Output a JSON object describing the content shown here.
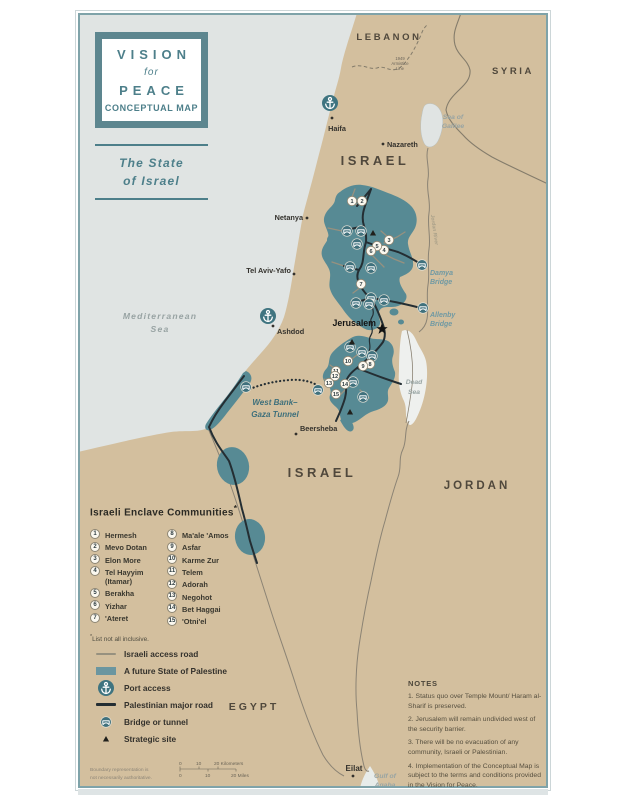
{
  "colors": {
    "teal": "#4d7f8a",
    "palestine_fill": "#578a94",
    "land": "#d3bf9e",
    "sea": "#e0e4e3",
    "road_black": "#242e33",
    "road_gray": "#97917f",
    "border_gray": "#847c6b"
  },
  "title_box": {
    "line1": "VISION",
    "line2": "for",
    "line3": "PEACE",
    "line4": "CONCEPTUAL MAP"
  },
  "subtitle": {
    "line1": "The State",
    "line2": "of Israel"
  },
  "map": {
    "country_labels": [
      {
        "label": "LEBANON",
        "x": 389,
        "y": 40,
        "size": 9.5,
        "ls": 2.6
      },
      {
        "label": "SYRIA",
        "x": 513,
        "y": 74,
        "size": 9.5,
        "ls": 2.6
      },
      {
        "label": "ISRAEL",
        "x": 375,
        "y": 165,
        "size": 13,
        "ls": 3.5
      },
      {
        "label": "ISRAEL",
        "x": 322,
        "y": 477,
        "size": 13,
        "ls": 3.5
      },
      {
        "label": "JORDAN",
        "x": 477,
        "y": 489,
        "size": 11.5,
        "ls": 3
      },
      {
        "label": "EGYPT",
        "x": 254,
        "y": 710,
        "size": 10.5,
        "ls": 3
      }
    ],
    "cities": [
      {
        "name": "Haifa",
        "lx": 337,
        "ly": 131,
        "anchor": "middle",
        "dx": 332,
        "dy": 118
      },
      {
        "name": "Nazareth",
        "lx": 387,
        "ly": 147,
        "anchor": "start",
        "dx": 383,
        "dy": 144
      },
      {
        "name": "Netanya",
        "lx": 303,
        "ly": 220,
        "anchor": "end",
        "dx": 307,
        "dy": 218
      },
      {
        "name": "Tel Aviv-Yafo",
        "lx": 291,
        "ly": 273,
        "anchor": "end",
        "dx": 294,
        "dy": 274
      },
      {
        "name": "Ashdod",
        "lx": 277,
        "ly": 334,
        "anchor": "start",
        "dx": 273,
        "dy": 326
      },
      {
        "name": "Beersheba",
        "lx": 300,
        "ly": 431,
        "anchor": "start",
        "dx": 296,
        "dy": 434
      },
      {
        "name": "Eilat",
        "lx": 354,
        "ly": 771,
        "anchor": "middle",
        "dx": 353,
        "dy": 776,
        "bold": true
      }
    ],
    "jerusalem": {
      "label": "Jerusalem",
      "lx": 376,
      "ly": 326,
      "star_x": 382,
      "star_y": 329
    },
    "waters": [
      {
        "lines": [
          "Mediterranean",
          "Sea"
        ],
        "x": 160,
        "y": 319,
        "lh": 13,
        "large": true,
        "name": "mediterranean-sea-label"
      },
      {
        "lines": [
          "Sea of",
          "Galilee"
        ],
        "x": 453,
        "y": 119,
        "lh": 9,
        "name": "sea-of-galilee-label"
      },
      {
        "lines": [
          "Dead",
          "Sea"
        ],
        "x": 414,
        "y": 384,
        "lh": 10,
        "name": "dead-sea-label"
      },
      {
        "lines": [
          "Gulf of",
          "Aqaba"
        ],
        "x": 385,
        "y": 778,
        "lh": 9,
        "name": "gulf-of-aqaba-label"
      }
    ],
    "river_label": {
      "text": "Jordan River",
      "x": 433,
      "y": 230,
      "rotate": 82
    },
    "bridge_names": [
      {
        "lines": [
          "Damya",
          "Bridge"
        ],
        "x": 430,
        "y": 275,
        "lh": 9,
        "anchor": "start",
        "name": "damya-bridge-label"
      },
      {
        "lines": [
          "Allenby",
          "Bridge"
        ],
        "x": 430,
        "y": 317,
        "lh": 9,
        "anchor": "start",
        "name": "allenby-bridge-label"
      }
    ],
    "tunnel_label": {
      "lines": [
        "West Bank–",
        "Gaza Tunnel"
      ],
      "x": 275,
      "y": 405,
      "lh": 12,
      "name": "west-bank-gaza-tunnel-label"
    },
    "armistice_label": {
      "lines": [
        "1949",
        "Armistice",
        "Line"
      ],
      "x": 400,
      "y": 60,
      "lh": 5,
      "name": "armistice-line-label"
    },
    "enclave_markers": [
      {
        "n": "1",
        "x": 352,
        "y": 201
      },
      {
        "n": "2",
        "x": 362,
        "y": 201
      },
      {
        "n": "3",
        "x": 389,
        "y": 240
      },
      {
        "n": "4",
        "x": 384,
        "y": 250
      },
      {
        "n": "5",
        "x": 377,
        "y": 246
      },
      {
        "n": "6",
        "x": 371,
        "y": 251
      },
      {
        "n": "7",
        "x": 361,
        "y": 284
      },
      {
        "n": "8",
        "x": 370,
        "y": 364
      },
      {
        "n": "9",
        "x": 363,
        "y": 366
      },
      {
        "n": "10",
        "x": 348,
        "y": 361
      },
      {
        "n": "11",
        "x": 336,
        "y": 371
      },
      {
        "n": "12",
        "x": 335,
        "y": 376
      },
      {
        "n": "13",
        "x": 329,
        "y": 383
      },
      {
        "n": "14",
        "x": 345,
        "y": 384
      },
      {
        "n": "15",
        "x": 336,
        "y": 394
      }
    ],
    "bridge_icons": [
      {
        "x": 347,
        "y": 231
      },
      {
        "x": 361,
        "y": 231
      },
      {
        "x": 357,
        "y": 244
      },
      {
        "x": 350,
        "y": 267
      },
      {
        "x": 371,
        "y": 268
      },
      {
        "x": 422,
        "y": 265
      },
      {
        "x": 423,
        "y": 308
      },
      {
        "x": 371,
        "y": 298
      },
      {
        "x": 384,
        "y": 300
      },
      {
        "x": 356,
        "y": 303
      },
      {
        "x": 369,
        "y": 304
      },
      {
        "x": 350,
        "y": 347
      },
      {
        "x": 362,
        "y": 352
      },
      {
        "x": 372,
        "y": 356
      },
      {
        "x": 353,
        "y": 382
      },
      {
        "x": 363,
        "y": 397
      },
      {
        "x": 318,
        "y": 390
      },
      {
        "x": 246,
        "y": 387
      }
    ],
    "ports": [
      {
        "x": 330,
        "y": 103
      },
      {
        "x": 268,
        "y": 316
      }
    ],
    "strategic_sites": [
      {
        "x": 373,
        "y": 233
      },
      {
        "x": 352,
        "y": 342
      },
      {
        "x": 350,
        "y": 412
      }
    ]
  },
  "legend_enclaves": {
    "title": "Israeli Enclave Communities",
    "title_sup": "*",
    "col1": [
      {
        "num": "1",
        "name": "Hermesh"
      },
      {
        "num": "2",
        "name": "Mevo Dotan"
      },
      {
        "num": "3",
        "name": "Elon More"
      },
      {
        "num": "4",
        "name": "Tel Hayyim",
        "name2": "(Itamar)"
      },
      {
        "num": "5",
        "name": "Berakha"
      },
      {
        "num": "6",
        "name": "Yizhar"
      },
      {
        "num": "7",
        "name": "'Ateret"
      }
    ],
    "col2": [
      {
        "num": "8",
        "name": "Ma'ale 'Amos"
      },
      {
        "num": "9",
        "name": "Asfar"
      },
      {
        "num": "10",
        "name": "Karme Zur"
      },
      {
        "num": "11",
        "name": "Telem"
      },
      {
        "num": "12",
        "name": "Adorah"
      },
      {
        "num": "13",
        "name": "Negohot"
      },
      {
        "num": "14",
        "name": "Bet Haggai"
      },
      {
        "num": "15",
        "name": "'Otni'el"
      }
    ],
    "footnote_sup": "*",
    "footnote": "List not all inclusive."
  },
  "legend_symbols": {
    "items": [
      {
        "icon": "israeli-access-road",
        "label": "Israeli access road"
      },
      {
        "icon": "future-state-of-palestine",
        "label": "A future State of Palestine"
      },
      {
        "icon": "port-access",
        "label": "Port access"
      },
      {
        "icon": "palestinian-major-road",
        "label": "Palestinian major road"
      },
      {
        "icon": "bridge-or-tunnel",
        "label": "Bridge or tunnel"
      },
      {
        "icon": "strategic-site",
        "label": "Strategic site"
      }
    ]
  },
  "notes": {
    "title": "NOTES",
    "items": [
      "1. Status quo over Temple Mount/ Haram al-Sharif is preserved.",
      "2. Jerusalem will remain undivided west of the security barrier.",
      "3. There will be no evacuation of any community, Israeli or Palestinian.",
      "4. Implementation of the Conceptual Map is subject to the terms and conditions provided in the Vision for Peace."
    ]
  },
  "footer": {
    "disclaimer_line1": "Boundary representation is",
    "disclaimer_line2": "not necessarily authoritative.",
    "scale_km": {
      "t0": "0",
      "t10": "10",
      "t20": "20 Kilometers"
    },
    "scale_mi": {
      "t0": "0",
      "t10": "10",
      "t20": "20 Miles"
    }
  }
}
